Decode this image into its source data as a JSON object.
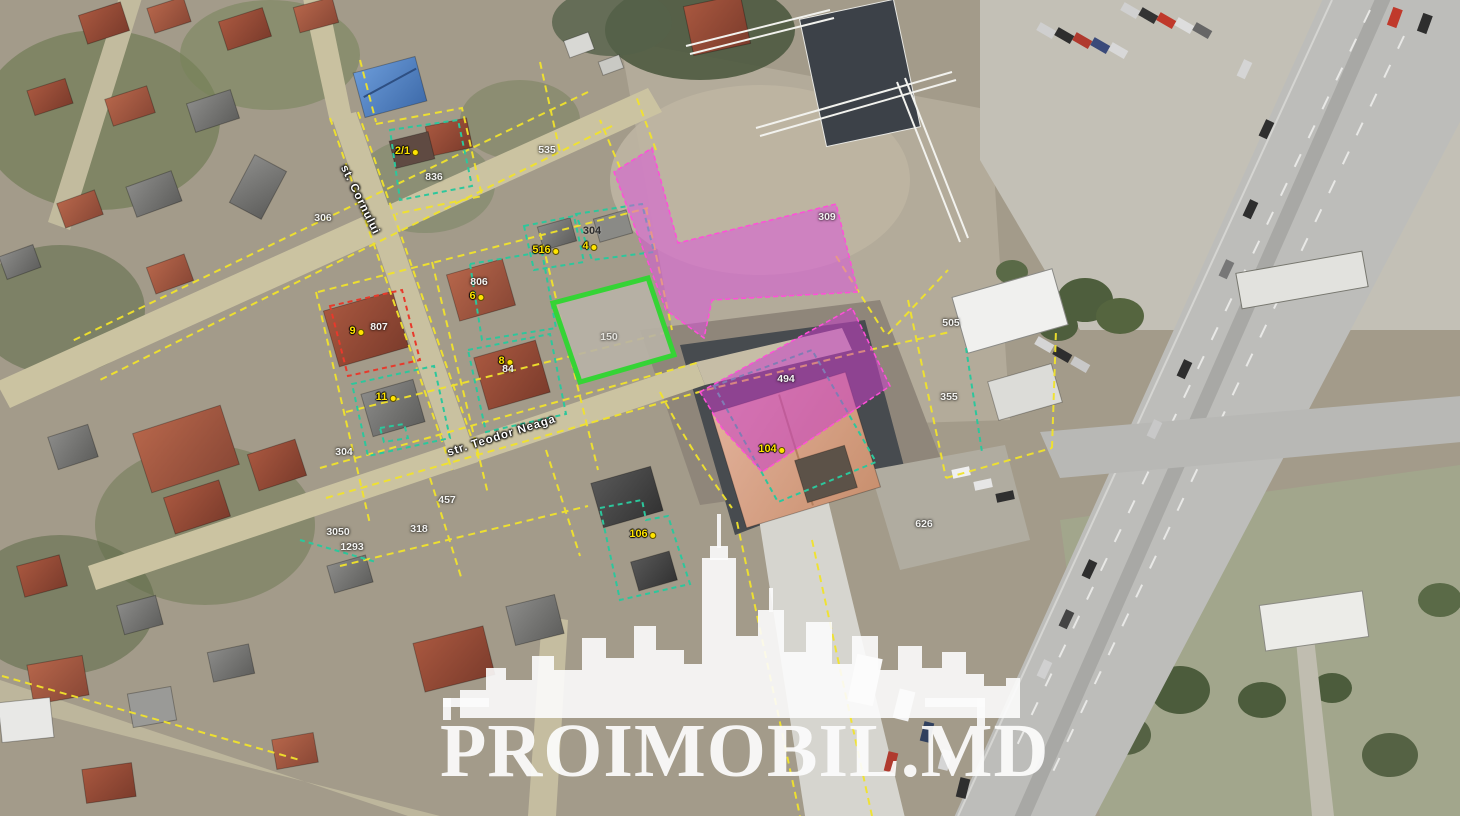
{
  "map": {
    "provider_watermark": "PROIMOBIL.MD",
    "imagery_type": "satellite-aerial-cadastral",
    "streets": [
      {
        "name": "st. Cornului"
      },
      {
        "name": "str. Teodor Neaga"
      }
    ],
    "labels": {
      "yellow": [
        {
          "text": "2/1"
        },
        {
          "text": "516"
        },
        {
          "text": "4"
        },
        {
          "text": "9"
        },
        {
          "text": "6"
        },
        {
          "text": "8"
        },
        {
          "text": "11"
        },
        {
          "text": "104"
        },
        {
          "text": "106"
        }
      ],
      "white": [
        {
          "text": "836"
        },
        {
          "text": "306"
        },
        {
          "text": "535"
        },
        {
          "text": "309"
        },
        {
          "text": "505"
        },
        {
          "text": "355"
        },
        {
          "text": "494"
        },
        {
          "text": "807"
        },
        {
          "text": "806"
        },
        {
          "text": "84"
        },
        {
          "text": "304"
        },
        {
          "text": "457"
        },
        {
          "text": "318"
        },
        {
          "text": "3050"
        },
        {
          "text": "1293"
        },
        {
          "text": "626"
        },
        {
          "text": "150"
        }
      ],
      "dark": [
        {
          "text": "304"
        }
      ]
    },
    "overlay_colors": {
      "cadastral_line": "#f1e32c",
      "parcel_line": "#2cc79c",
      "selected_parcel": "#35d435",
      "zone_highlight": "#e04fe0",
      "restricted_parcel": "#e8392b",
      "watermark": "#fcfcfc"
    }
  }
}
